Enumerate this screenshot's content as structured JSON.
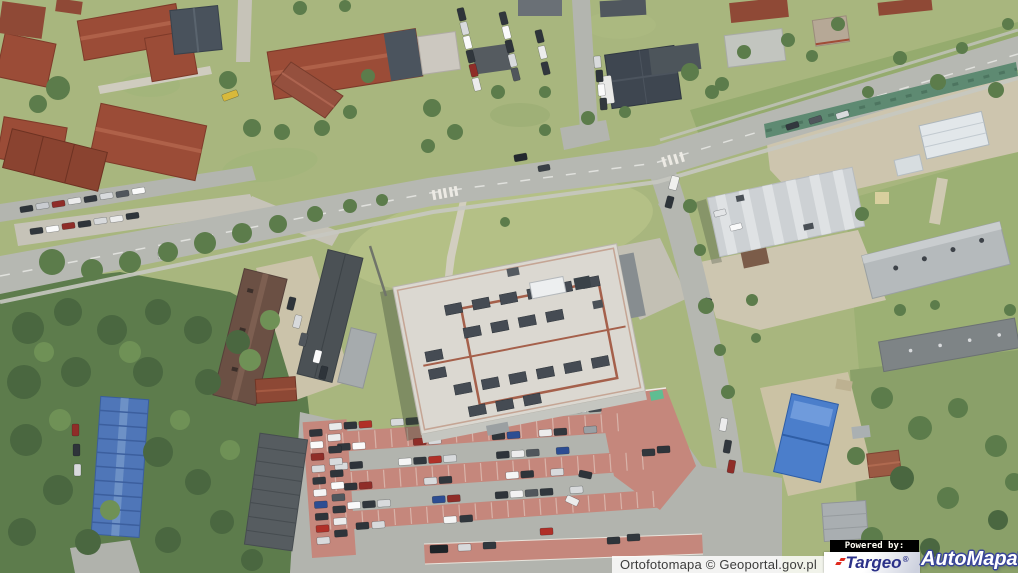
{
  "attribution": {
    "text": "Ortofotomapa © Geoportal.gov.pl"
  },
  "branding": {
    "powered_by_label": "Powered by:",
    "targeo": {
      "name": "Targeo",
      "registered_mark": "®"
    },
    "automapa": {
      "name": "AutoMapa",
      "registered_mark": "®"
    }
  },
  "colors": {
    "targeo_navy": "#2b3189",
    "targeo_red": "#e02a1e",
    "automapa_fill": "#ffffff",
    "automapa_outline": "#39459a",
    "powered_by_bg": "#000000",
    "powered_by_text": "#fffdf4",
    "attribution_bg": "#ffffff",
    "attribution_text": "#3c3c3c"
  },
  "map": {
    "type": "aerial-orthophoto",
    "notable_features": [
      "residential blocks with red tiled roofs (north-west)",
      "main road running diagonally with intersection",
      "large flat-roof supermarket with skylights and red roof trim (centre)",
      "customer car park with red paved stalls and many cars (south of supermarket)",
      "industrial warehouse, greenhouses and yards (east)",
      "two grey flat-roof apartment blocks (east)",
      "blue metal-roof buildings (south-west and east)",
      "dense woodland (south-west)"
    ]
  }
}
